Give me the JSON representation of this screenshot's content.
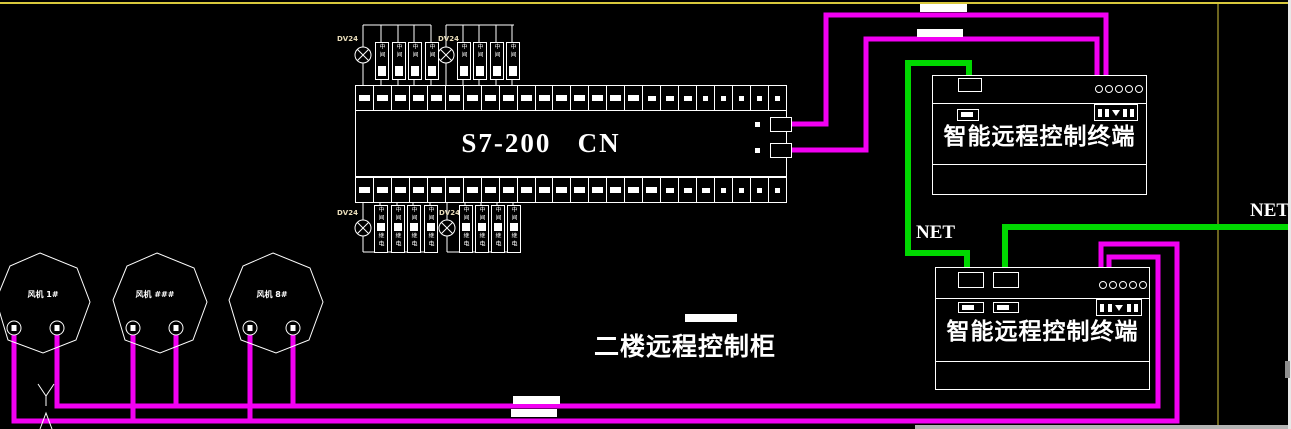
{
  "cabinet_label": "二楼远程控制柜",
  "plc": {
    "label": "S7-200   CN"
  },
  "terminal_boxes": [
    {
      "title": "智能远程控制终端"
    },
    {
      "title": "智能远程控制终端"
    }
  ],
  "net_labels": [
    "NET",
    "NET"
  ],
  "fans": [
    {
      "label": "风机 1#",
      "cx": 43,
      "label_left": 13,
      "terminals": [
        14,
        57
      ]
    },
    {
      "label": "风机 ###",
      "cx": 160,
      "label_left": 125,
      "terminals": [
        133,
        176
      ]
    },
    {
      "label": "风机 8#",
      "cx": 276,
      "label_left": 242,
      "terminals": [
        250,
        293
      ]
    }
  ],
  "fan_shape": {
    "points": [
      [
        -3,
        253
      ],
      [
        34,
        268
      ],
      [
        47,
        302
      ],
      [
        33,
        340
      ],
      [
        0,
        353
      ],
      [
        -35,
        340
      ],
      [
        -47,
        300
      ],
      [
        -33,
        266
      ]
    ],
    "terminal_cy": 328
  },
  "colors": {
    "background": "#000000",
    "magenta": "#f200f2",
    "green": "#00d800",
    "yellow": "#d8c83c",
    "white": "#ffffff"
  },
  "relay_assembly": {
    "power_label": "DV24",
    "top_chars": [
      "中",
      "间"
    ],
    "bottom_chars": [
      "中",
      "间",
      "继",
      "电"
    ],
    "groups": [
      {
        "type": "top",
        "bus_y": 25,
        "bus_x1": 363,
        "bus_x2": 431,
        "lamp_cx": 363,
        "lamp_cy": 55,
        "relays_x": [
          375,
          392,
          408,
          425
        ],
        "relay_y": 42,
        "relay_h": 36,
        "strip_y": 85,
        "label_dx": -26,
        "label_y": 35
      },
      {
        "type": "top",
        "bus_y": 25,
        "bus_x1": 446,
        "bus_x2": 514,
        "lamp_cx": 446,
        "lamp_cy": 55,
        "relays_x": [
          457,
          473,
          490,
          506
        ],
        "relay_y": 42,
        "relay_h": 36,
        "strip_y": 85,
        "label_dx": -8,
        "label_y": 35
      },
      {
        "type": "bottom",
        "bus_y": 252,
        "bus_x1": 363,
        "bus_x2": 431,
        "lamp_cx": 363,
        "lamp_cy": 228,
        "relays_x": [
          374,
          391,
          407,
          424
        ],
        "relay_y": 205,
        "relay_h": 46,
        "strip_y": 202,
        "label_dx": -26,
        "label_y": 209
      },
      {
        "type": "bottom",
        "bus_y": 252,
        "bus_x1": 447,
        "bus_x2": 513,
        "lamp_cx": 447,
        "lamp_cy": 228,
        "relays_x": [
          459,
          475,
          491,
          507
        ],
        "relay_y": 205,
        "relay_h": 46,
        "strip_y": 202,
        "label_dx": -8,
        "label_y": 209
      }
    ]
  },
  "geometry": {
    "canvas": {
      "w": 1291,
      "h": 429
    },
    "yellow_lines": [
      {
        "name": "frame-line-top",
        "points": [
          [
            0,
            3
          ],
          [
            1288,
            3
          ]
        ],
        "w": 2
      },
      {
        "name": "frame-line-vertical",
        "points": [
          [
            1218,
            4
          ],
          [
            1218,
            429
          ]
        ],
        "w": 1
      }
    ],
    "magenta_wires": [
      {
        "name": "plc-to-terminal1-wire-a",
        "points": [
          [
            788,
            124
          ],
          [
            826,
            124
          ],
          [
            826,
            15
          ],
          [
            1106,
            15
          ],
          [
            1106,
            84
          ]
        ]
      },
      {
        "name": "plc-to-terminal1-wire-b",
        "points": [
          [
            788,
            150
          ],
          [
            866,
            150
          ],
          [
            866,
            39
          ],
          [
            1097,
            39
          ],
          [
            1097,
            84
          ]
        ]
      },
      {
        "name": "terminal2-to-fans-bus-lower",
        "points": [
          [
            1101,
            281
          ],
          [
            1101,
            244
          ],
          [
            1177,
            244
          ],
          [
            1177,
            421
          ],
          [
            14,
            421
          ],
          [
            14,
            330
          ]
        ]
      },
      {
        "name": "terminal2-to-fans-bus-upper",
        "points": [
          [
            1109,
            281
          ],
          [
            1109,
            257
          ],
          [
            1158,
            257
          ],
          [
            1158,
            406
          ],
          [
            57,
            406
          ],
          [
            57,
            330
          ]
        ]
      },
      {
        "name": "fan2-drop-lower",
        "points": [
          [
            133,
            330
          ],
          [
            133,
            421
          ]
        ]
      },
      {
        "name": "fan3-drop-lower",
        "points": [
          [
            250,
            330
          ],
          [
            250,
            421
          ]
        ]
      },
      {
        "name": "fan2-drop-upper",
        "points": [
          [
            176,
            330
          ],
          [
            176,
            406
          ]
        ]
      },
      {
        "name": "fan3-drop-upper",
        "points": [
          [
            293,
            330
          ],
          [
            293,
            406
          ]
        ]
      }
    ],
    "green_wires": [
      {
        "name": "net-wire-terminal1-to-terminal2",
        "points": [
          [
            969,
            84
          ],
          [
            969,
            63
          ],
          [
            908,
            63
          ],
          [
            908,
            253
          ],
          [
            967,
            253
          ],
          [
            967,
            274
          ]
        ]
      },
      {
        "name": "net-wire-external",
        "points": [
          [
            1291,
            227
          ],
          [
            1005,
            227
          ],
          [
            1005,
            274
          ]
        ]
      }
    ],
    "deco_marks": [
      {
        "name": "wire-mark-y-left",
        "points": [
          [
            38,
            384
          ],
          [
            46,
            396
          ],
          [
            46,
            406
          ]
        ]
      },
      {
        "name": "wire-mark-y-right",
        "points": [
          [
            54,
            384
          ],
          [
            46,
            396
          ]
        ]
      },
      {
        "name": "wire-mark-arrow",
        "points": [
          [
            40,
            429
          ],
          [
            46,
            413
          ],
          [
            52,
            429
          ]
        ]
      }
    ],
    "strips": {
      "x": 355,
      "w": 430,
      "top_y": 85,
      "bottom_y": 177,
      "h": 24,
      "cells": 24
    }
  }
}
